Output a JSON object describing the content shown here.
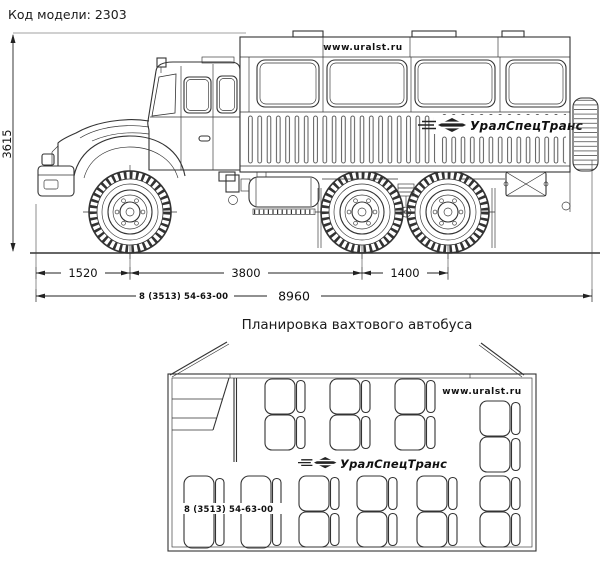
{
  "header": {
    "model_code": "Код модели: 2303"
  },
  "ink": {
    "line_color": "#333333",
    "text_color": "#111111"
  },
  "side_view": {
    "website": "www.uralst.ru",
    "brand": "УралСпецТранс",
    "phone": "8 (3513) 54-63-00",
    "dimensions": {
      "height_mm": "3615",
      "front_overhang_mm": "1520",
      "wheelbase_mm": "3800",
      "bogie_spacing_mm": "1400",
      "overall_length_mm": "8960"
    }
  },
  "plan_view": {
    "title": "Планировка вахтового автобуса",
    "website": "www.uralst.ru",
    "brand": "УралСпецТранс",
    "phone": "8 (3513) 54-63-00"
  }
}
